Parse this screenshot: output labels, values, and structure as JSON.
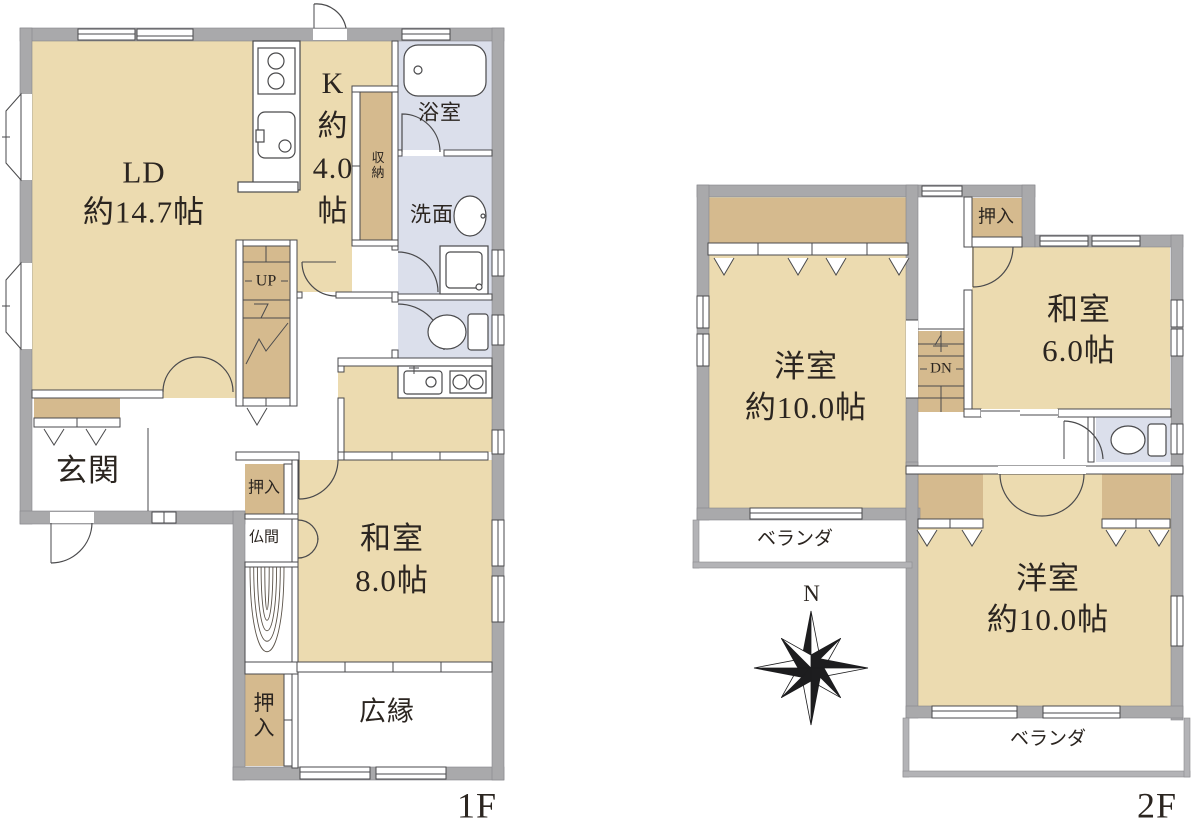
{
  "colors": {
    "room_beige": "#ecdbb0",
    "closet_tan": "#d5ba8e",
    "wet_area_blue": "#dbdfeb",
    "wall_gray": "#a9a9ab",
    "line": "#4a4a4c",
    "text": "#2b2520"
  },
  "floor1": {
    "floor_label": "1F",
    "rooms": {
      "living_dining": {
        "label": "LD\n約14.7帖"
      },
      "kitchen": {
        "label": "K\n約\n4.0\n帖"
      },
      "bathroom": {
        "label": "浴室"
      },
      "storage": {
        "label": "収\n納"
      },
      "washroom": {
        "label": "洗面"
      },
      "stairs": {
        "label": "UP"
      },
      "entrance": {
        "label": "玄関"
      },
      "closet_hall": {
        "label": "押入"
      },
      "butsuma": {
        "label": "仏間"
      },
      "washitsu": {
        "label": "和室\n8.0帖"
      },
      "hiroen": {
        "label": "広縁"
      },
      "closet_south": {
        "label": "押\n入"
      }
    }
  },
  "floor2": {
    "floor_label": "2F",
    "rooms": {
      "western_nw": {
        "label": "洋室\n約10.0帖"
      },
      "oshiire": {
        "label": "押入"
      },
      "washitsu": {
        "label": "和室\n6.0帖"
      },
      "stairs": {
        "label": "DN"
      },
      "balcony_west": {
        "label": "ベランダ"
      },
      "western_se": {
        "label": "洋室\n約10.0帖"
      },
      "balcony_south": {
        "label": "ベランダ"
      }
    }
  },
  "compass": {
    "north_label": "N"
  },
  "fixtures": [
    "bathtub",
    "wash-basin",
    "washing-machine",
    "toilet-1f",
    "kitchen-stove",
    "kitchen-sink",
    "kitchenette-sink",
    "kitchenette-stove",
    "toilet-2f",
    "stairs-up",
    "stairs-down",
    "tokonoma"
  ]
}
